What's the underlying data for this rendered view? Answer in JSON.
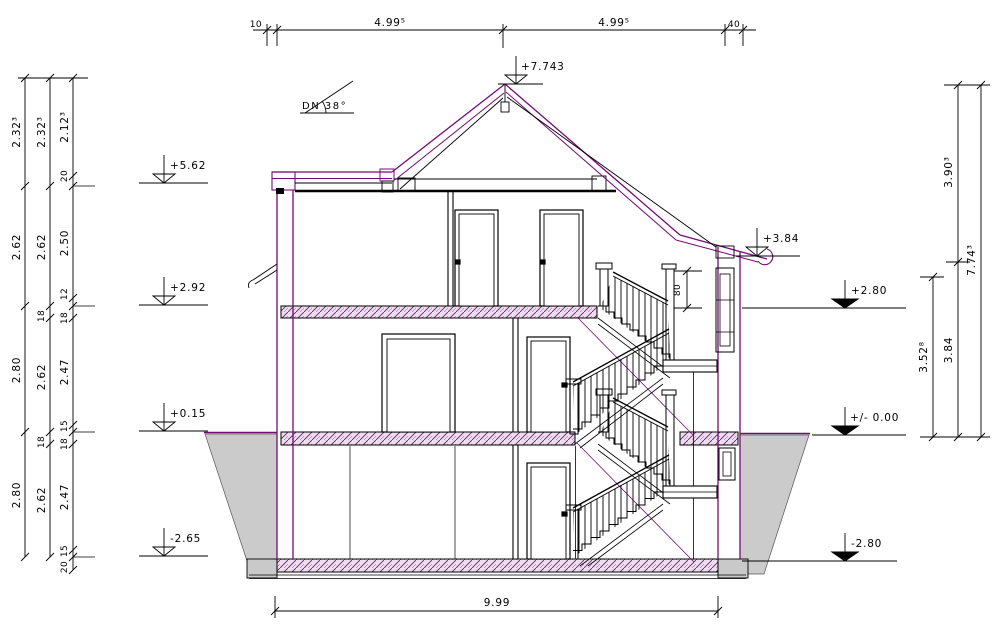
{
  "annotations": {
    "roof_pitch": "DN 38°",
    "stair_rail_height": "80"
  },
  "dimensions": {
    "top": {
      "overhang": "10",
      "left_span": "4.99⁵",
      "right_span": "4.99⁵",
      "wall": "40"
    },
    "bottom": {
      "total_width": "9.99"
    },
    "left": {
      "col1": [
        "2.32³",
        "2.62",
        "2.80",
        "2.80"
      ],
      "col2": [
        "2.32³",
        "2.62",
        "18",
        "2.62",
        "18",
        "2.62"
      ],
      "col3": [
        "2.12³",
        "20",
        "2.50",
        "12",
        "18",
        "2.47",
        "15",
        "18",
        "2.47",
        "15",
        "20"
      ]
    },
    "right": {
      "knee": "3.52⁸",
      "roof": "3.90³",
      "story": "3.84",
      "total": "7.74³"
    }
  },
  "levels": {
    "ridge": "+7.743",
    "left": [
      "+5.62",
      "+2.92",
      "+0.15",
      "-2.65"
    ],
    "eaves": "+3.84",
    "right": [
      "+2.80",
      "+/- 0.00",
      "-2.80"
    ]
  },
  "colors": {
    "line": "#000000",
    "cad_purple": "#750b75",
    "slab_fill": "#ebdfed",
    "terrain_fill": "#cbcbcb"
  }
}
